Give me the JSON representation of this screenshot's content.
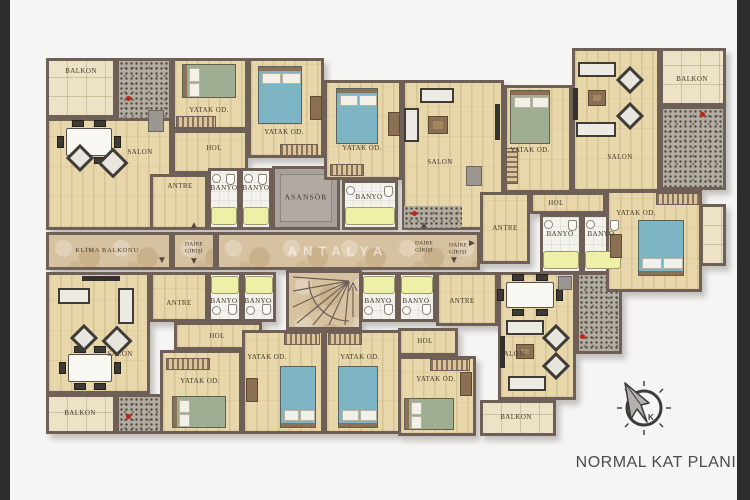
{
  "title": "NORMAL KAT PLANI",
  "watermark": "ANTALYA",
  "compass": {
    "north_letter": "K"
  },
  "colors": {
    "wall": "#6e6056",
    "wood_floor": "#e8d7aa",
    "marble_floor": "#d6c2a0",
    "balcony_tile": "#ece3c6",
    "bath_floor": "#f3f2ec",
    "granite_counter": "#b3ada1",
    "elevator": "#a8a19b",
    "bed_blue": "#7db5c4",
    "bed_green": "#9fae93",
    "bathtub_yellow": "#eff0a8",
    "label_text": "#41372c",
    "side_bar": "#2c2c2c",
    "title_text": "#4b4b4b"
  },
  "rooms": [
    {
      "id": "balkon_tl",
      "label": "BALKON"
    },
    {
      "id": "yatak_tl",
      "label": "YATAK OD."
    },
    {
      "id": "salon_tl",
      "label": "SALON"
    },
    {
      "id": "hol_tl",
      "label": "HOL"
    },
    {
      "id": "antre_tl",
      "label": "ANTRE"
    },
    {
      "id": "banyo_tl_a",
      "label": "BANYO"
    },
    {
      "id": "banyo_tl_b",
      "label": "BANYO"
    },
    {
      "id": "asansor",
      "label": "ASANSÖR"
    },
    {
      "id": "yatak_tm1",
      "label": "YATAK OD."
    },
    {
      "id": "yatak_tm2",
      "label": "YATAK OD."
    },
    {
      "id": "banyo_tm",
      "label": "BANYO"
    },
    {
      "id": "salon_tm",
      "label": "SALON"
    },
    {
      "id": "yatak_tm3",
      "label": "YATAK OD."
    },
    {
      "id": "salon_tr",
      "label": "SALON"
    },
    {
      "id": "balkon_tr",
      "label": "BALKON"
    },
    {
      "id": "hol_tr",
      "label": "HOL"
    },
    {
      "id": "antre_tr",
      "label": "ANTRE"
    },
    {
      "id": "banyo_tr_a",
      "label": "BANYO"
    },
    {
      "id": "banyo_tr_b",
      "label": "BANYO"
    },
    {
      "id": "yatak_tr",
      "label": "YATAK OD."
    },
    {
      "id": "klima_balkonu",
      "label": "KLİMA BALKONU"
    },
    {
      "id": "dg_left",
      "label": "DAİRE GİRİŞİ"
    },
    {
      "id": "dg_c1",
      "label": "DAİRE GİRİŞİ"
    },
    {
      "id": "dg_c2",
      "label": "DAİRE GİRİŞİ"
    },
    {
      "id": "salon_bl",
      "label": "SALON"
    },
    {
      "id": "antre_bl",
      "label": "ANTRE"
    },
    {
      "id": "banyo_bl_a",
      "label": "BANYO"
    },
    {
      "id": "banyo_bl_b",
      "label": "BANYO"
    },
    {
      "id": "hol_bl",
      "label": "HOL"
    },
    {
      "id": "yatak_bl",
      "label": "YATAK OD."
    },
    {
      "id": "balkon_bl",
      "label": "BALKON"
    },
    {
      "id": "yatak_bc1",
      "label": "YATAK OD."
    },
    {
      "id": "yatak_bc2",
      "label": "YATAK OD."
    },
    {
      "id": "banyo_br_a",
      "label": "BANYO"
    },
    {
      "id": "banyo_br_b",
      "label": "BANYO"
    },
    {
      "id": "antre_br",
      "label": "ANTRE"
    },
    {
      "id": "hol_br",
      "label": "HOL"
    },
    {
      "id": "yatak_br",
      "label": "YATAK OD."
    },
    {
      "id": "salon_br",
      "label": "SALON"
    },
    {
      "id": "balkon_br",
      "label": "BALKON"
    }
  ]
}
